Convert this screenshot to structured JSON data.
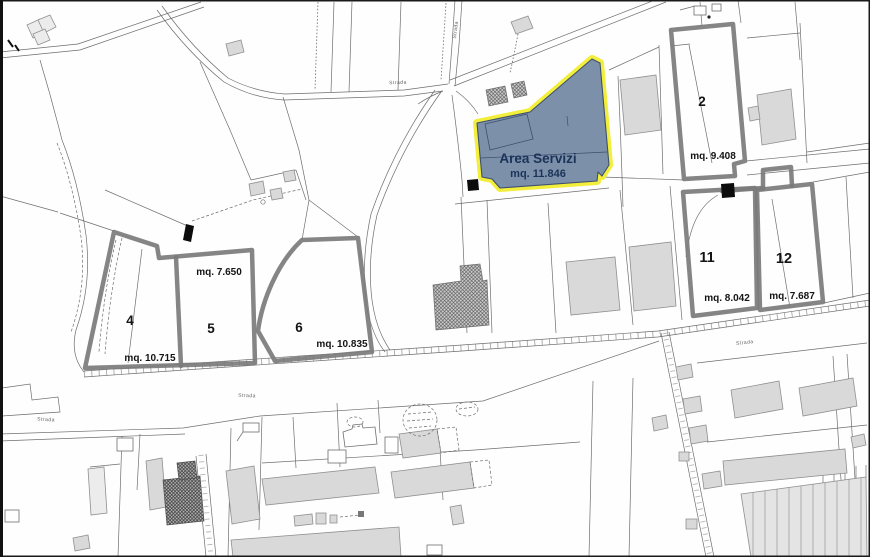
{
  "map": {
    "area_servizi": {
      "label": "Area Servizi",
      "area": "mq. 11.846"
    },
    "parcels": [
      {
        "id": "2",
        "area": "mq. 9.408"
      },
      {
        "id": "4",
        "area": "mq. 10.715"
      },
      {
        "id": "5",
        "area": "mq. 7.650"
      },
      {
        "id": "6",
        "area": "mq. 10.835"
      },
      {
        "id": "11",
        "area": "mq. 8.042"
      },
      {
        "id": "12",
        "area": "mq. 7.687"
      }
    ],
    "road_labels": [
      "Strada",
      "Strada",
      "Strada",
      "Strada",
      "Strada"
    ],
    "colors": {
      "highlight_fill": "#7d90aa",
      "highlight_border": "#f2ee3b",
      "highlight_text": "#1b3358",
      "parcel_outline": "#7b7b7b",
      "building_fill": "#d9d9d9",
      "map_line": "#5f5f5f"
    }
  }
}
